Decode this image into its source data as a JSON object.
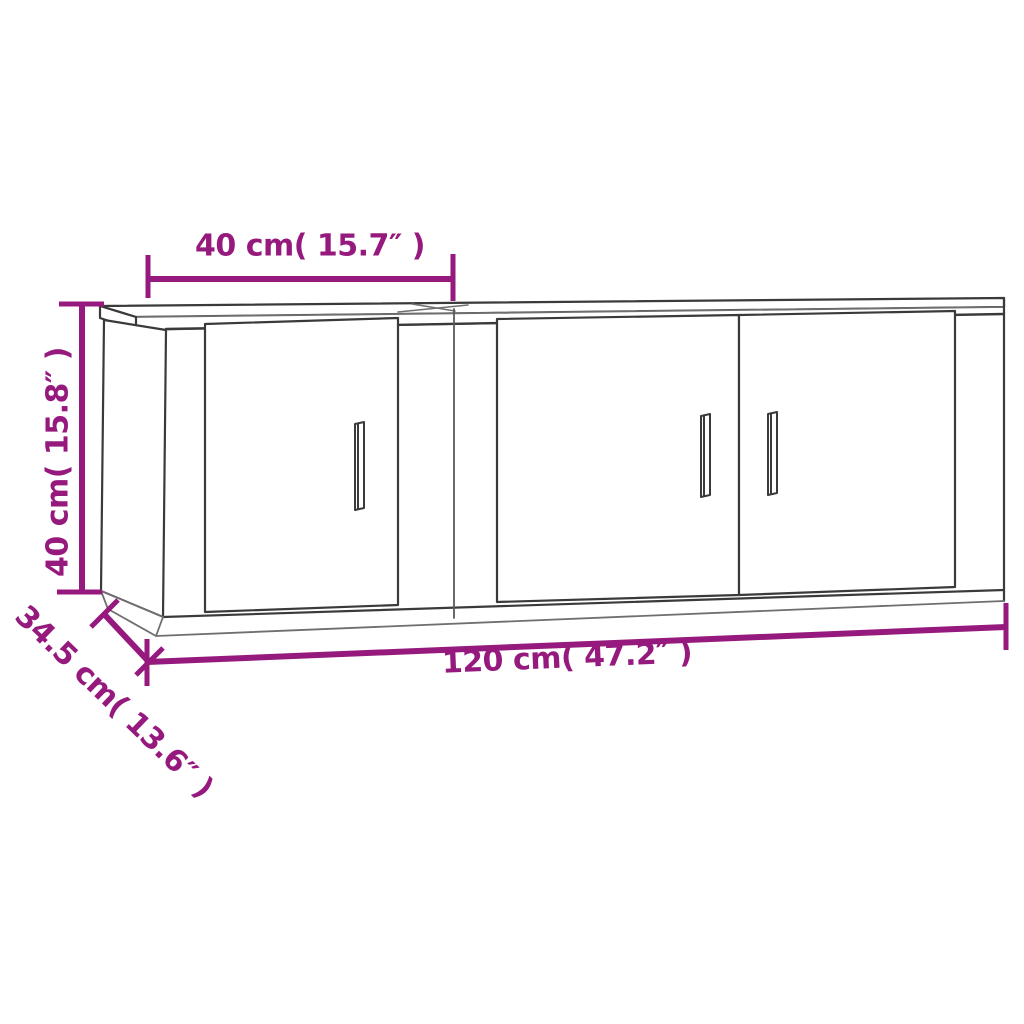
{
  "diagram": {
    "kind": "furniture-dimension-drawing",
    "subject": "2-piece wall TV cabinet set: one single-door unit and one double-door unit",
    "labels": {
      "top_width": "40 cm( 15.7″ )",
      "side_height": "40 cm( 15.8″ )",
      "depth": "34.5 cm( 13.6″ )",
      "total_width": "120 cm( 47.2″ )"
    },
    "measurements": {
      "left_unit_width_cm": 40,
      "left_unit_width_in": 15.7,
      "height_cm": 40,
      "height_in": 15.8,
      "depth_cm": 34.5,
      "depth_in": 13.6,
      "total_width_cm": 120,
      "total_width_in": 47.2
    },
    "colors": {
      "dimension_accent": "#961a7e",
      "line_art_dark": "#3a3a3a",
      "line_art_light": "#7a7a7a",
      "background": "#ffffff"
    }
  }
}
